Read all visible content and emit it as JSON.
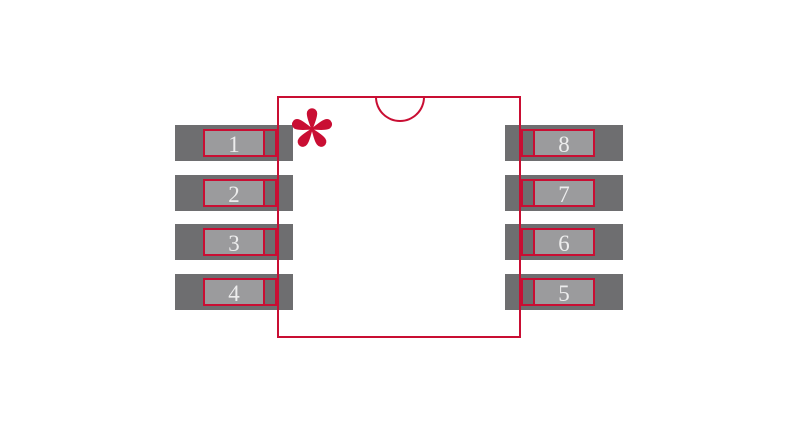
{
  "diagram": {
    "kind": "ic-package-footprint",
    "pin_count": 8
  },
  "colors": {
    "outline_red": "#c90e33",
    "pad_gray": "#6e6e70",
    "pin_gray": "#9b9b9d",
    "pin_number_text": "#ededed",
    "background": "#ffffff"
  },
  "pins": {
    "left": [
      {
        "number": "1"
      },
      {
        "number": "2"
      },
      {
        "number": "3"
      },
      {
        "number": "4"
      }
    ],
    "right": [
      {
        "number": "8"
      },
      {
        "number": "7"
      },
      {
        "number": "6"
      },
      {
        "number": "5"
      }
    ]
  },
  "icons": {
    "pin1_marker": "asterisk",
    "orientation_notch": "semicircle"
  }
}
